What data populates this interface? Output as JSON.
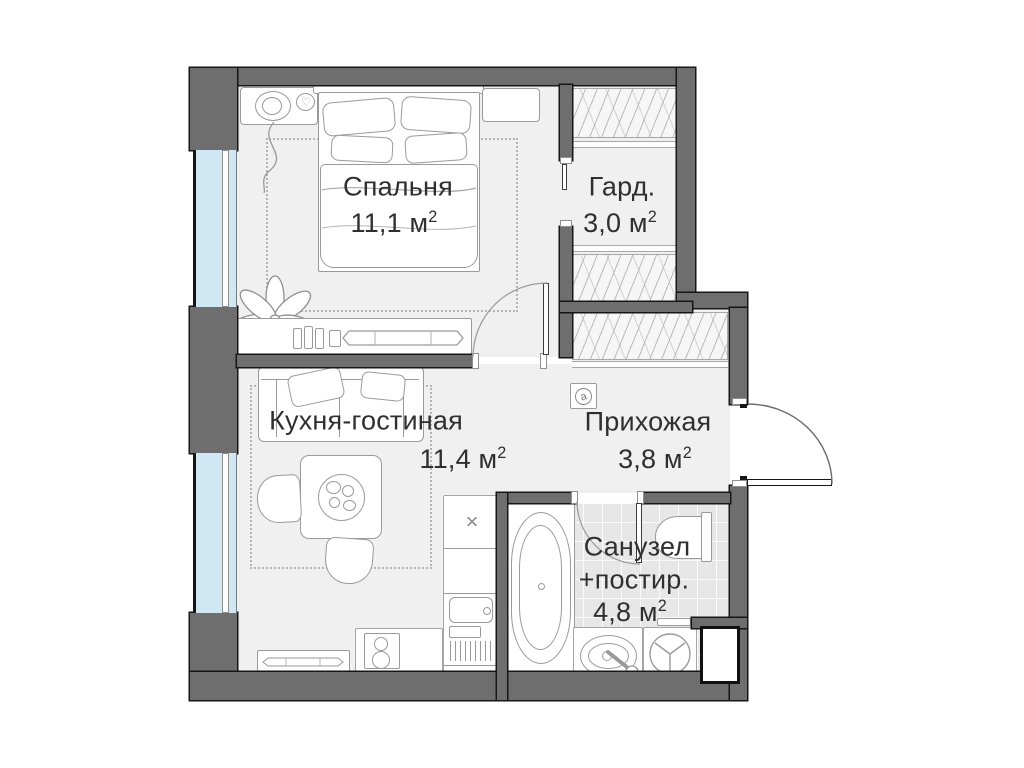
{
  "plan": {
    "rooms": [
      {
        "name": "Спальня",
        "area": "11,1 м",
        "sup": "2"
      },
      {
        "name": "Гард.",
        "area": "3,0 м",
        "sup": "2"
      },
      {
        "name": "Кухня-гостиная",
        "area": "11,4 м",
        "sup": "2"
      },
      {
        "name": "Прихожая",
        "area": "3,8 м",
        "sup": "2"
      },
      {
        "name": "Санузел",
        "name2": "+постир.",
        "area": "4,8 м",
        "sup": "2"
      }
    ],
    "symbols": {
      "electrical_panel": "a",
      "kitchen_sink_mark": "×",
      "heart_decor": "♡"
    },
    "colors": {
      "wall": "#6e6e6e",
      "outline": "#161616",
      "floor": "#f0f0f0",
      "tile": "#e7e7e7",
      "glass": "#cfe8f4",
      "furniture_line": "#9a9a9a",
      "text": "#2f2f2f"
    }
  }
}
